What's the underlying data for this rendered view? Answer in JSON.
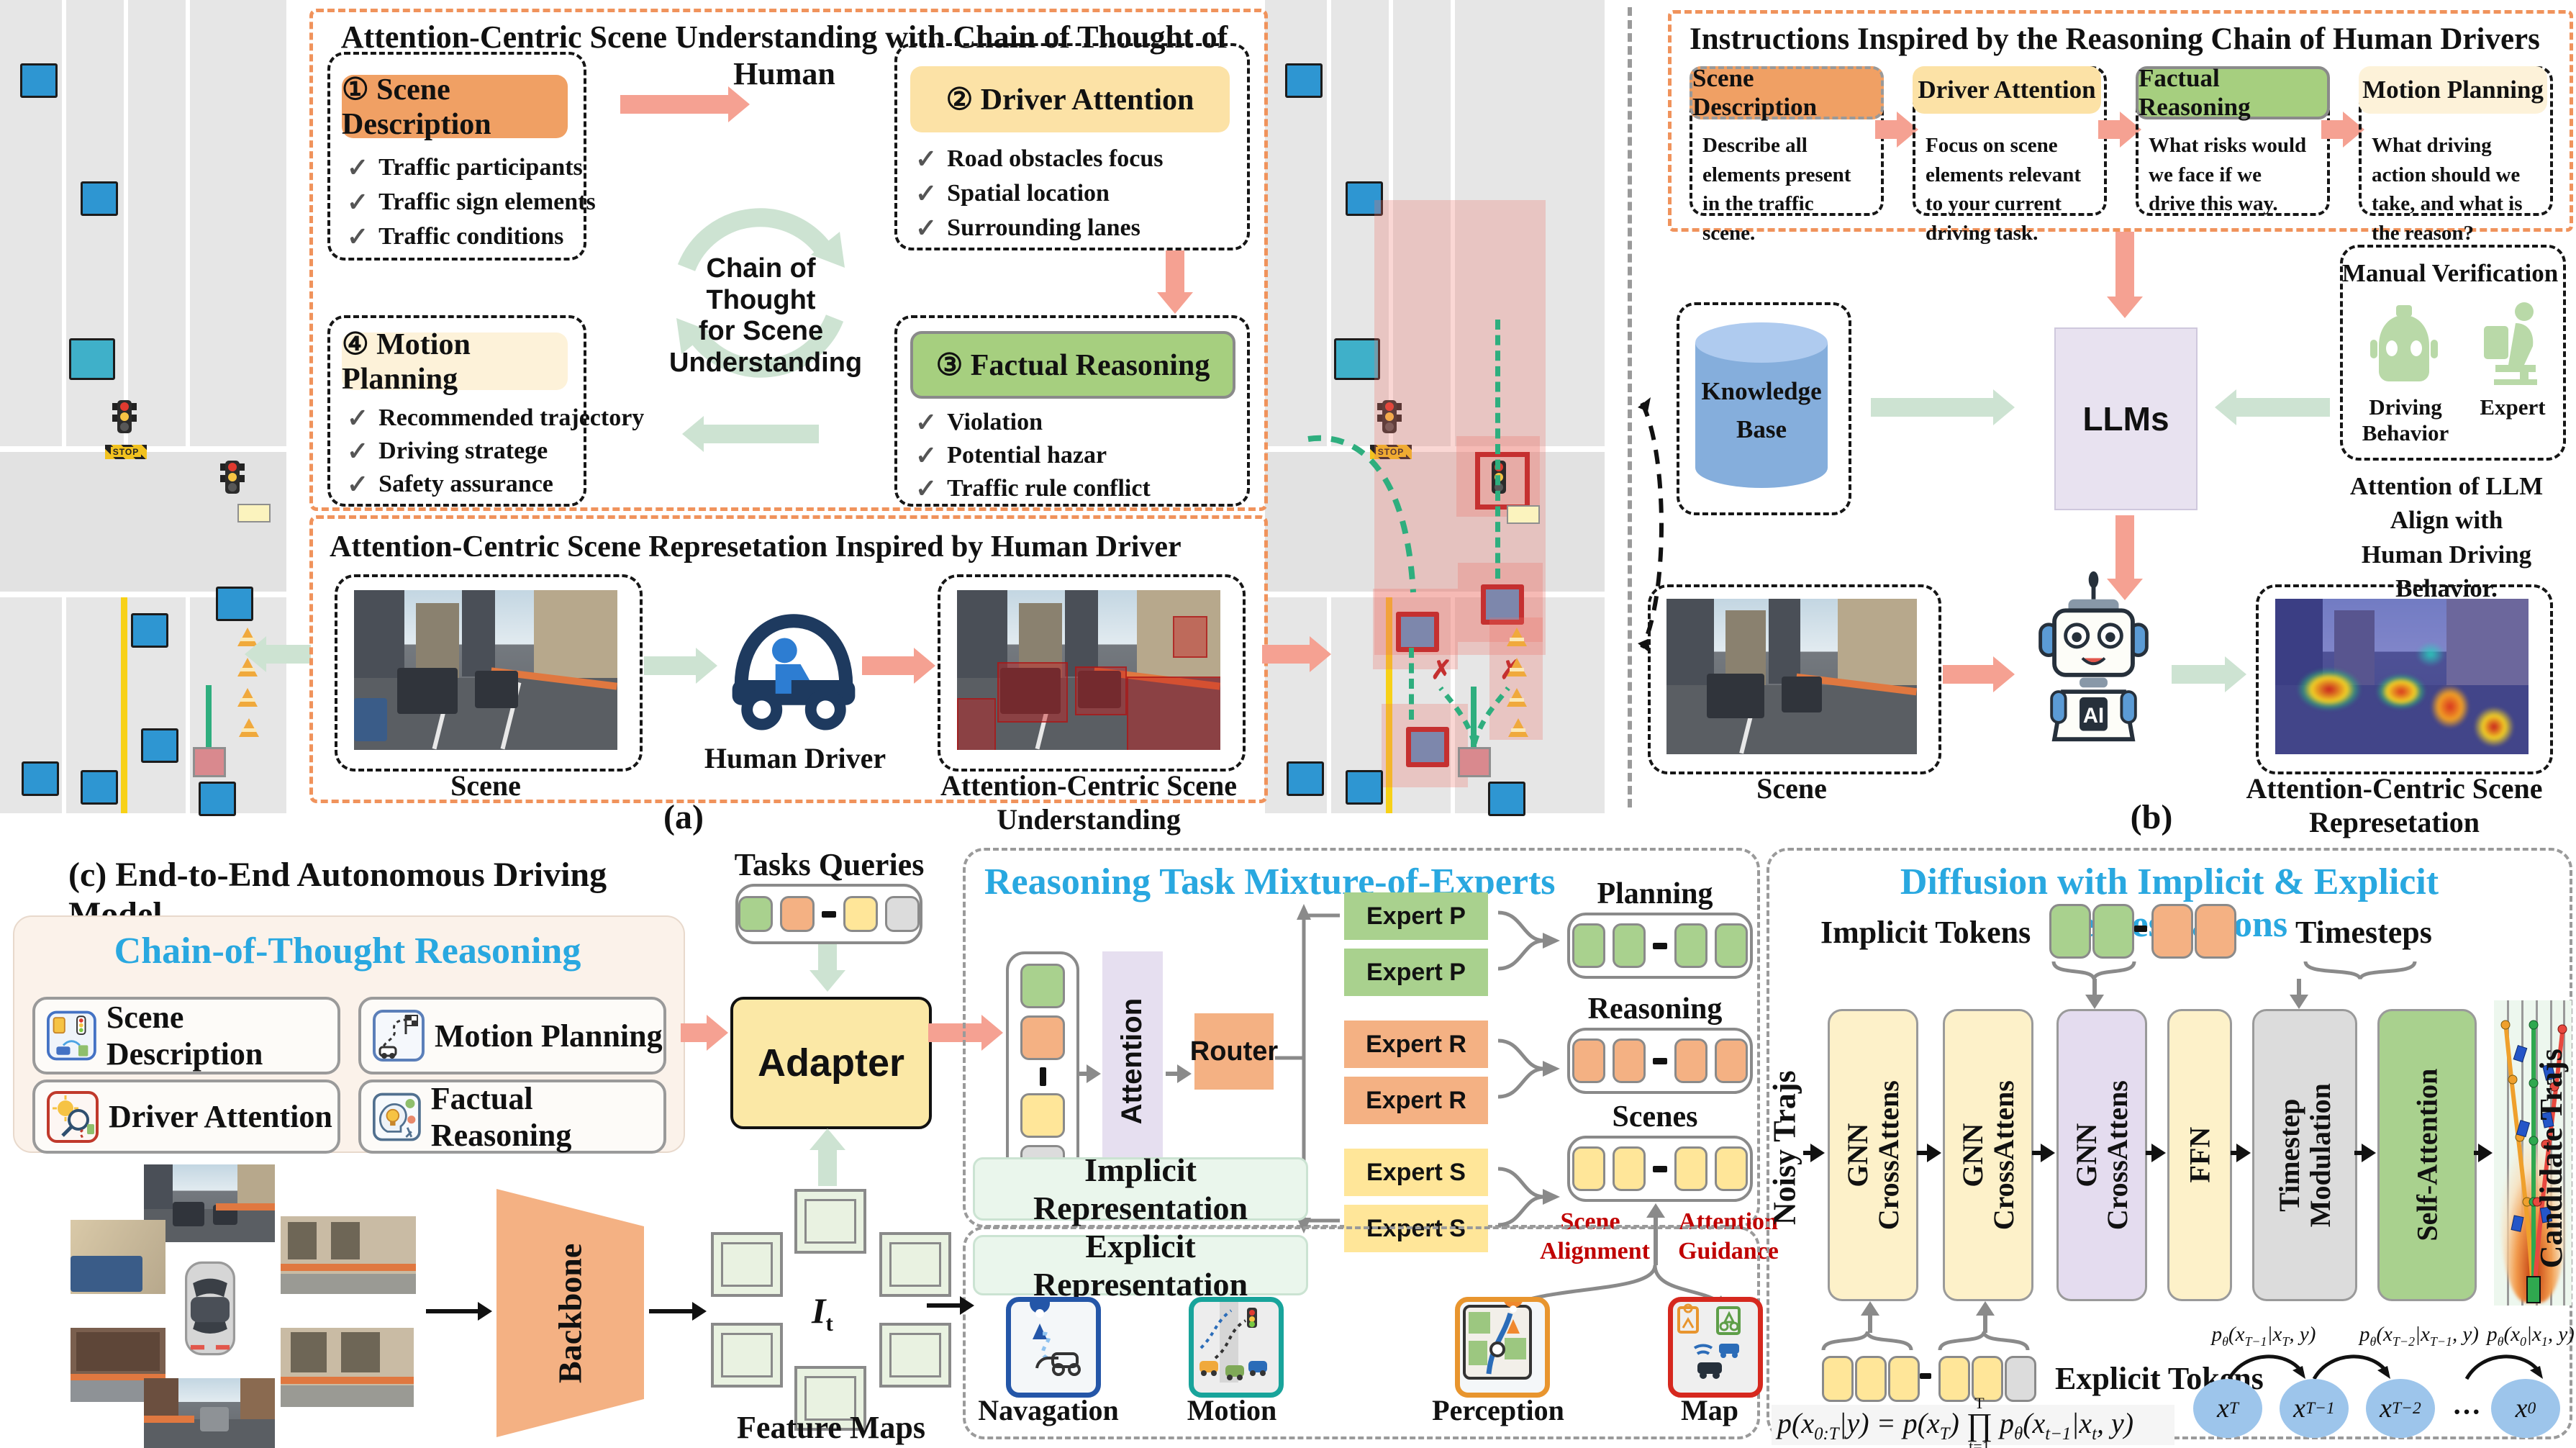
{
  "icons": {
    "check": "✓",
    "x_mark": "✗",
    "stop": "STOP"
  },
  "road": {
    "stop_label": "STOP"
  },
  "panel_a": {
    "caption": "(a)",
    "top": {
      "title": "Attention-Centric Scene Understanding with Chain of Thought of Human",
      "center_lines": [
        "Chain of Thought",
        "for Scene",
        "Understanding"
      ],
      "boxes": [
        {
          "title": "① Scene Description",
          "items": [
            "Traffic participants",
            "Traffic sign elements",
            "Traffic conditions"
          ]
        },
        {
          "title": "② Driver Attention",
          "items": [
            "Road obstacles focus",
            "Spatial location",
            "Surrounding lanes"
          ]
        },
        {
          "title": "③ Factual Reasoning",
          "items": [
            "Violation",
            "Potential hazar",
            "Traffic rule conflict"
          ]
        },
        {
          "title": "④ Motion Planning",
          "items": [
            "Recommended trajectory",
            "Driving stratege",
            "Safety assurance"
          ]
        }
      ]
    },
    "bottom": {
      "title": "Attention-Centric Scene Represetation Inspired by Human Driver",
      "scene_label": "Scene",
      "driver_label": "Human Driver",
      "understanding_label": "Attention-Centric Scene Understanding"
    }
  },
  "panel_b": {
    "caption": "(b)",
    "instructions": {
      "title": "Instructions Inspired by the Reasoning Chain of Human Drivers",
      "steps": [
        {
          "title": "Scene Description",
          "desc": "Describe all elements present in the traffic scene."
        },
        {
          "title": "Driver Attention",
          "desc": "Focus on scene elements relevant to your current driving task."
        },
        {
          "title": "Factual Reasoning",
          "desc": "What risks would we face if we drive this way."
        },
        {
          "title": "Motion Planning",
          "desc": "What driving action should we take, and what is the reason?"
        }
      ]
    },
    "middle": {
      "knowledge_base_lines": [
        "Knowledge",
        "Base"
      ],
      "llms": "LLMs",
      "manual_verification": "Manual Verification",
      "driving_behavior": "Driving Behavior",
      "expert": "Expert",
      "align_note_lines": [
        "Attention of LLM Align with",
        "Human Driving Behavior."
      ]
    },
    "bottom": {
      "scene_label": "Scene",
      "robot_ai": "AI",
      "representation_label": "Attention-Centric Scene Represetation"
    }
  },
  "panel_c": {
    "title": "(c) End-to-End Autonomous Driving Model",
    "cot": {
      "title": "Chain-of-Thought Reasoning",
      "items": [
        "Scene Description",
        "Motion Planning",
        "Driver Attention",
        "Factual Reasoning"
      ]
    },
    "tasks_queries": "Tasks Queries",
    "adapter": "Adapter",
    "backbone": "Backbone",
    "it_label_html": "<i>I</i><sub>t</sub>",
    "feature_maps": "Feature Maps",
    "moe": {
      "title": "Reasoning Task Mixture-of-Experts",
      "attention": "Attention",
      "router": "Router",
      "experts": [
        "Expert P",
        "Expert P",
        "Expert R",
        "Expert R",
        "Expert S",
        "Expert S"
      ],
      "token_groups": [
        "Planning Tokens",
        "Reasoning Tokens",
        "Scenes Tokens"
      ],
      "scene_alignment_lines": [
        "Scene",
        "Alignment"
      ],
      "attention_guidance_lines": [
        "Attention",
        "Guidance"
      ],
      "implicit": "Implicit Representation",
      "explicit": "Explicit Representation",
      "explicit_items": [
        "Navagation",
        "Motion",
        "Perception",
        "Map"
      ]
    },
    "diffusion": {
      "title": "Diffusion with Implicit & Explicit Represetations",
      "implicit_tokens": "Implicit Tokens",
      "timesteps": "Timesteps",
      "noisy_trajs": "Noisy Trajs",
      "blocks": [
        [
          "GNN",
          "CrossAttens"
        ],
        [
          "GNN",
          "CrossAttens"
        ],
        [
          "GNN",
          "CrossAttens"
        ],
        [
          "FFN",
          ""
        ],
        [
          "Timestep",
          "Modulation"
        ],
        [
          "Self-Attention",
          ""
        ]
      ],
      "candidate_trajs": "Candidate Trajs",
      "explicit_tokens": "Explicit Tokens",
      "formula": {
        "lhs_html": "p(x<sub>0:T</sub>|y) = p(x<sub>T</sub>)",
        "prod_top": "T",
        "prod_symbol": "∏",
        "prod_bottom": "t=1",
        "rhs_html": "p<sub>θ</sub>(x<sub>t−1</sub>|x<sub>t</sub>, y)"
      },
      "chain_labels_html": [
        "p<sub>θ</sub>(x<sub>T−1</sub>|x<sub>T</sub>, y)",
        "p<sub>θ</sub>(x<sub>T−2</sub>|x<sub>T−1</sub>, y)",
        "p<sub>θ</sub>(x<sub>0</sub>|x<sub>1</sub>, y)"
      ],
      "nodes_html": [
        "x<sub>T</sub>",
        "x<sub>T−1</sub>",
        "x<sub>T−2</sub>",
        "···",
        "x<sub>0</sub>"
      ]
    }
  }
}
